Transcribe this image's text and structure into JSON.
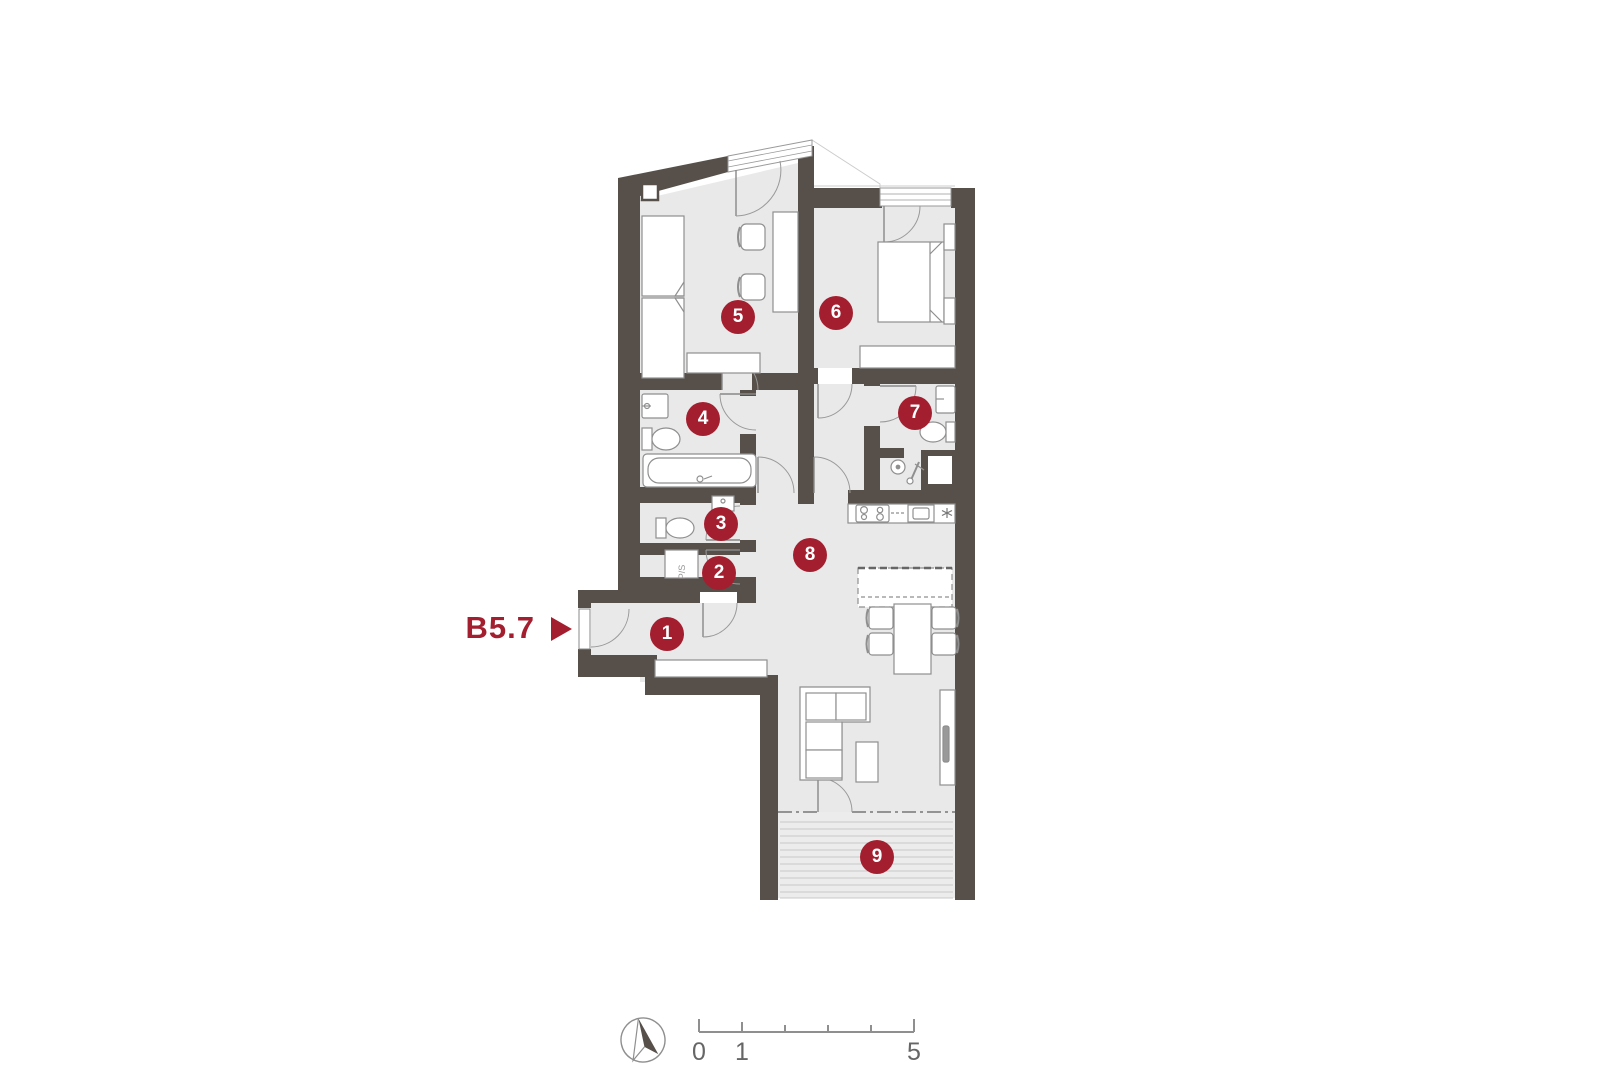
{
  "unit": {
    "label": "B5.7"
  },
  "rooms": [
    {
      "number": "1"
    },
    {
      "number": "2"
    },
    {
      "number": "3"
    },
    {
      "number": "4"
    },
    {
      "number": "5"
    },
    {
      "number": "6"
    },
    {
      "number": "7"
    },
    {
      "number": "8"
    },
    {
      "number": "9"
    }
  ],
  "labels": {
    "ps": "P/S"
  },
  "scale_bar": {
    "tick_labels": [
      "0",
      "1",
      "5"
    ]
  },
  "colors": {
    "accent_red": "#A31F2F",
    "wall": "#57504A",
    "floor": "#E9E9E9",
    "terrace_floor": "#ECECEC",
    "furniture_stroke": "#8F8F8F"
  }
}
